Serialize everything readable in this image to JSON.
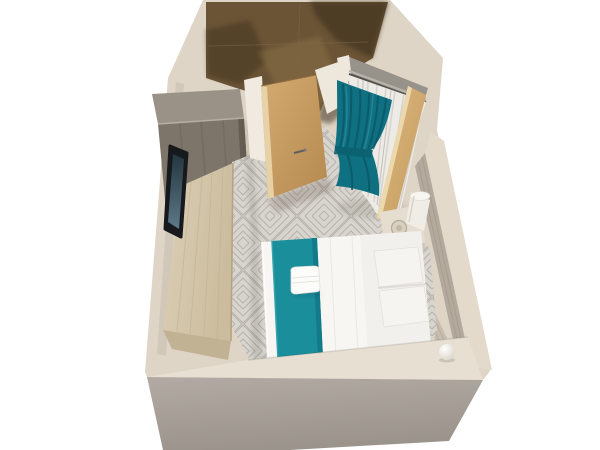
{
  "meta": {
    "description": "3D axonometric cutaway render of a hotel guest room floor plan on a white background",
    "width": 600,
    "height": 450
  },
  "palette": {
    "background": "#ffffff",
    "platform_top": "#ded5c6",
    "front_wall_inner": "#e7dfd1",
    "left_wall_inner": "#cfc6b8",
    "marble": "#6b5436",
    "marble_dark": "#473723",
    "marble_light": "#8d7349",
    "carpet_base": "#d8d4ce",
    "carpet_line": "#a9a49c",
    "wardrobe_top": "#9b9287",
    "wardrobe_front": "#7e756a",
    "desk_end": "#c2b294",
    "door_frame": "#f0eae0",
    "wall_corner": "#ede7dc",
    "recess": "#97928a",
    "sheer_curtain": "#edebe6",
    "teal_curtain": "#0e7080",
    "right_wall_top": "#e3dacb",
    "right_wall_inner": "#b3aa9d",
    "headboard": "#c7beb0",
    "nightstand": "#e5ddcf",
    "lamp": "#f0ede7",
    "duvet": "#f7f6f3",
    "runner_teal": "#1b8e9c",
    "pillow": "#f5f4f0",
    "towel": "#fcfcfb",
    "tv_frame": "#17191c"
  },
  "scene": {
    "elements": [
      "room platform base",
      "dark marble bathroom floor",
      "open wooden entrance door",
      "grey wardrobe cabinet",
      "long wooden desk console",
      "wall mounted tv",
      "grey diamond-pattern carpet",
      "white sheer curtain",
      "tied teal curtain",
      "leaning wooden door panel",
      "bedside table with round tray",
      "white table lamp",
      "headboard panel",
      "tilted right wall",
      "double bed with white duvet",
      "teal bed runner",
      "folded white towel",
      "two white pillows",
      "white decor sphere"
    ]
  }
}
